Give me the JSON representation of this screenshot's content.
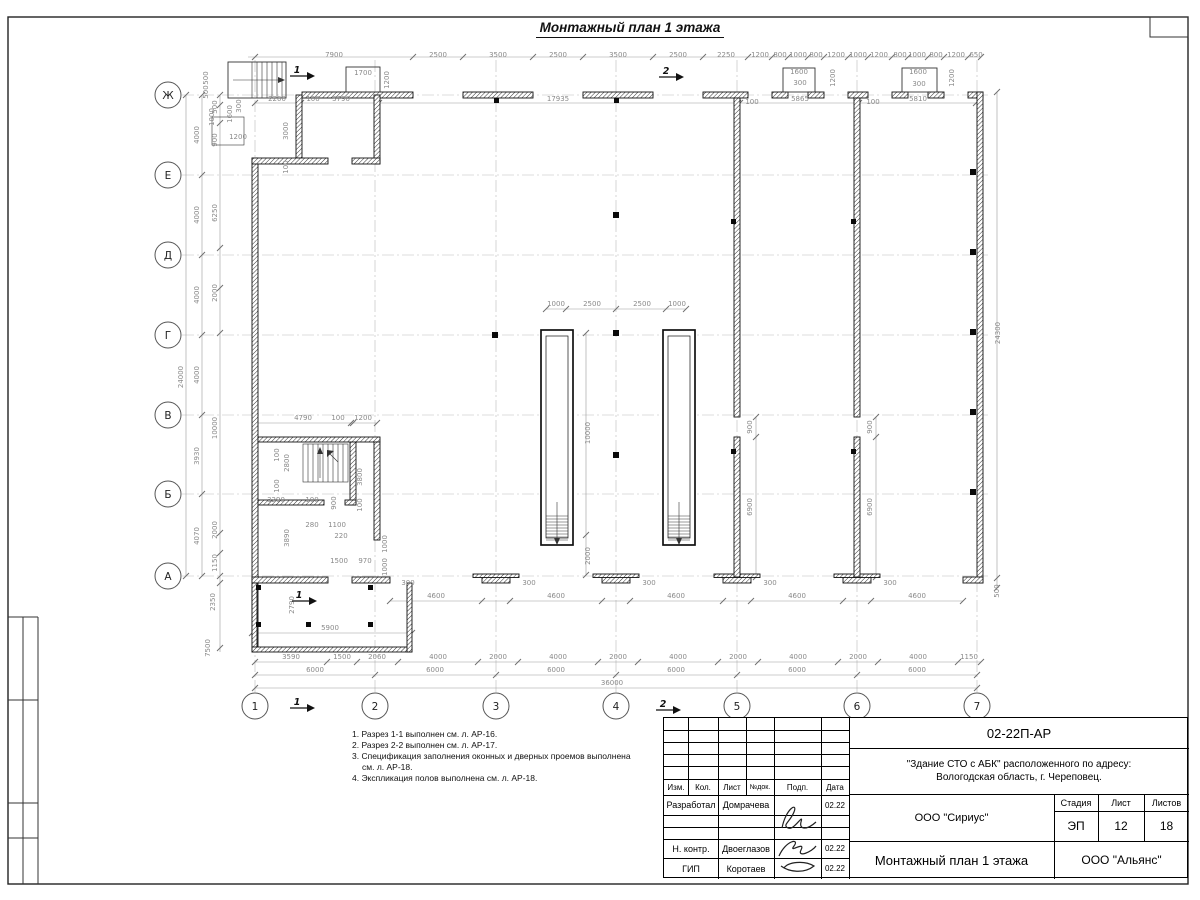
{
  "colors": {
    "ink": "#111111",
    "dim_gray": "#8a8a8a",
    "grid_gray": "#b9b9b9"
  },
  "plan": {
    "title": "Монтажный план 1 этажа",
    "axis_rows": [
      {
        "label": "Ж",
        "y": 95
      },
      {
        "label": "Е",
        "y": 175
      },
      {
        "label": "Д",
        "y": 255
      },
      {
        "label": "Г",
        "y": 335
      },
      {
        "label": "В",
        "y": 415
      },
      {
        "label": "Б",
        "y": 494
      },
      {
        "label": "А",
        "y": 576
      }
    ],
    "axis_cols": [
      {
        "label": "1",
        "x": 255
      },
      {
        "label": "2",
        "x": 375
      },
      {
        "label": "3",
        "x": 496
      },
      {
        "label": "4",
        "x": 616
      },
      {
        "label": "5",
        "x": 737
      },
      {
        "label": "6",
        "x": 857
      },
      {
        "label": "7",
        "x": 977
      }
    ],
    "dim_lines": [
      {
        "y": 57,
        "x1": 248,
        "x2": 981,
        "ticks": [
          255,
          413,
          463,
          533,
          583,
          653,
          703,
          748,
          772,
          788,
          808,
          824,
          848,
          868,
          892,
          908,
          928,
          944,
          968,
          981
        ]
      },
      {
        "y": 103,
        "x1": 255,
        "x2": 976,
        "ticks": [
          255,
          299,
          301,
          377,
          379,
          738,
          740,
          857,
          859,
          976
        ]
      },
      {
        "y": 309,
        "x1": 546,
        "x2": 686,
        "ticks": [
          546,
          566,
          616,
          666,
          686
        ]
      },
      {
        "y": 423,
        "x1": 255,
        "x2": 377,
        "ticks": [
          255,
          351,
          353,
          377
        ]
      },
      {
        "y": 601,
        "x1": 390,
        "x2": 963,
        "ticks": [
          390,
          482,
          510,
          602,
          630,
          723,
          751,
          843,
          871,
          963
        ]
      },
      {
        "y": 633,
        "x1": 252,
        "x2": 412,
        "ticks": [
          252,
          412
        ]
      },
      {
        "y": 662,
        "x1": 255,
        "x2": 981,
        "ticks": [
          255,
          327,
          357,
          398,
          478,
          518,
          598,
          638,
          718,
          758,
          838,
          878,
          958,
          981
        ]
      },
      {
        "y": 675,
        "x1": 255,
        "x2": 977,
        "ticks": [
          255,
          375,
          496,
          616,
          737,
          857,
          977
        ]
      },
      {
        "y": 688,
        "x1": 255,
        "x2": 977,
        "ticks": [
          255,
          977
        ]
      },
      {
        "x": 186,
        "y1": 95,
        "y2": 576,
        "ticks": [
          95,
          576
        ]
      },
      {
        "x": 202,
        "y1": 95,
        "y2": 576,
        "ticks": [
          95,
          175,
          255,
          335,
          415,
          494,
          576
        ]
      },
      {
        "x": 220,
        "y1": 95,
        "y2": 652,
        "ticks": [
          95,
          105,
          123,
          248,
          288,
          333,
          533,
          553,
          576,
          583,
          648
        ]
      },
      {
        "x": 997,
        "y1": 92,
        "y2": 588,
        "ticks": [
          92,
          578,
          588
        ]
      },
      {
        "x": 586,
        "y1": 333,
        "y2": 575,
        "ticks": [
          333,
          535,
          575
        ]
      },
      {
        "x": 756,
        "y1": 417,
        "y2": 577,
        "ticks": [
          417,
          437,
          577
        ]
      },
      {
        "x": 876,
        "y1": 417,
        "y2": 577,
        "ticks": [
          417,
          437,
          577
        ]
      }
    ],
    "dim_labels": [
      [
        334,
        57,
        "7900",
        0
      ],
      [
        438,
        57,
        "2500",
        0
      ],
      [
        498,
        57,
        "3500",
        0
      ],
      [
        558,
        57,
        "2500",
        0
      ],
      [
        618,
        57,
        "3500",
        0
      ],
      [
        678,
        57,
        "2500",
        0
      ],
      [
        726,
        57,
        "2250",
        0
      ],
      [
        760,
        57,
        "1200",
        0
      ],
      [
        780,
        57,
        "800",
        0
      ],
      [
        798,
        57,
        "1000",
        0
      ],
      [
        816,
        57,
        "800",
        0
      ],
      [
        836,
        57,
        "1200",
        0
      ],
      [
        858,
        57,
        "1000",
        0
      ],
      [
        879,
        57,
        "1200",
        0
      ],
      [
        900,
        57,
        "800",
        0
      ],
      [
        917,
        57,
        "1000",
        0
      ],
      [
        936,
        57,
        "800",
        0
      ],
      [
        956,
        57,
        "1200",
        0
      ],
      [
        976,
        57,
        "650",
        0
      ],
      [
        363,
        75,
        "1700",
        0
      ],
      [
        389,
        80,
        "1200",
        1
      ],
      [
        799,
        74,
        "1600",
        0
      ],
      [
        800,
        85,
        "300",
        0
      ],
      [
        835,
        78,
        "1200",
        1
      ],
      [
        918,
        74,
        "1600",
        0
      ],
      [
        919,
        86,
        "300",
        0
      ],
      [
        954,
        78,
        "1200",
        1
      ],
      [
        277,
        101,
        "2200",
        0
      ],
      [
        313,
        101,
        "100",
        0
      ],
      [
        341,
        101,
        "3790",
        0
      ],
      [
        558,
        101,
        "17935",
        0
      ],
      [
        752,
        104,
        "100",
        0
      ],
      [
        800,
        101,
        "5865",
        0
      ],
      [
        873,
        104,
        "100",
        0
      ],
      [
        918,
        101,
        "5810",
        0
      ],
      [
        183,
        377,
        "24000",
        1
      ],
      [
        199,
        135,
        "4000",
        1
      ],
      [
        199,
        215,
        "4000",
        1
      ],
      [
        199,
        295,
        "4000",
        1
      ],
      [
        199,
        375,
        "4000",
        1
      ],
      [
        199,
        456,
        "3930",
        1
      ],
      [
        199,
        536,
        "4070",
        1
      ],
      [
        217,
        107,
        "500",
        1
      ],
      [
        217,
        140,
        "900",
        1
      ],
      [
        217,
        213,
        "6250",
        1
      ],
      [
        217,
        293,
        "2000",
        1
      ],
      [
        217,
        428,
        "10000",
        1
      ],
      [
        217,
        530,
        "2000",
        1
      ],
      [
        217,
        563,
        "1150",
        1
      ],
      [
        215,
        602,
        "2350",
        1
      ],
      [
        210,
        648,
        "7500",
        1
      ],
      [
        208,
        78,
        "500",
        1
      ],
      [
        208,
        92,
        "500",
        1
      ],
      [
        214,
        117,
        "1000",
        1
      ],
      [
        232,
        114,
        "1600",
        1
      ],
      [
        241,
        106,
        "300",
        1
      ],
      [
        238,
        139,
        "1200",
        0
      ],
      [
        288,
        131,
        "3000",
        1
      ],
      [
        288,
        167,
        "100",
        1
      ],
      [
        1000,
        333,
        "24300",
        1
      ],
      [
        999,
        591,
        "500",
        1
      ],
      [
        556,
        306,
        "1000",
        0
      ],
      [
        592,
        306,
        "2500",
        0
      ],
      [
        642,
        306,
        "2500",
        0
      ],
      [
        677,
        306,
        "1000",
        0
      ],
      [
        590,
        433,
        "10000",
        1
      ],
      [
        590,
        556,
        "2000",
        1
      ],
      [
        752,
        427,
        "900",
        1
      ],
      [
        752,
        507,
        "6900",
        1
      ],
      [
        872,
        427,
        "900",
        1
      ],
      [
        872,
        507,
        "6900",
        1
      ],
      [
        303,
        420,
        "4790",
        0
      ],
      [
        338,
        420,
        "100",
        0
      ],
      [
        363,
        420,
        "1200",
        0
      ],
      [
        279,
        455,
        "100",
        1
      ],
      [
        289,
        463,
        "2800",
        1
      ],
      [
        279,
        486,
        "100",
        1
      ],
      [
        276,
        502,
        "3290",
        0
      ],
      [
        312,
        502,
        "100",
        0
      ],
      [
        336,
        503,
        "900",
        1
      ],
      [
        362,
        477,
        "3800",
        1
      ],
      [
        362,
        505,
        "100",
        1
      ],
      [
        312,
        527,
        "280",
        0
      ],
      [
        337,
        527,
        "1100",
        0
      ],
      [
        341,
        538,
        "220",
        0
      ],
      [
        289,
        538,
        "3890",
        1
      ],
      [
        339,
        563,
        "1500",
        0
      ],
      [
        365,
        563,
        "970",
        0
      ],
      [
        387,
        544,
        "1000",
        1
      ],
      [
        387,
        567,
        "1000",
        1
      ],
      [
        408,
        585,
        "300",
        0
      ],
      [
        529,
        585,
        "300",
        0
      ],
      [
        649,
        585,
        "300",
        0
      ],
      [
        770,
        585,
        "300",
        0
      ],
      [
        890,
        585,
        "300",
        0
      ],
      [
        436,
        598,
        "4600",
        0
      ],
      [
        556,
        598,
        "4600",
        0
      ],
      [
        676,
        598,
        "4600",
        0
      ],
      [
        797,
        598,
        "4600",
        0
      ],
      [
        917,
        598,
        "4600",
        0
      ],
      [
        294,
        605,
        "2790",
        1
      ],
      [
        330,
        630,
        "5900",
        0
      ],
      [
        291,
        659,
        "3590",
        0
      ],
      [
        342,
        659,
        "1500",
        0
      ],
      [
        377,
        659,
        "2060",
        0
      ],
      [
        438,
        659,
        "4000",
        0
      ],
      [
        498,
        659,
        "2000",
        0
      ],
      [
        558,
        659,
        "4000",
        0
      ],
      [
        618,
        659,
        "2000",
        0
      ],
      [
        678,
        659,
        "4000",
        0
      ],
      [
        738,
        659,
        "2000",
        0
      ],
      [
        798,
        659,
        "4000",
        0
      ],
      [
        858,
        659,
        "2000",
        0
      ],
      [
        918,
        659,
        "4000",
        0
      ],
      [
        969,
        659,
        "1150",
        0
      ],
      [
        315,
        672,
        "6000",
        0
      ],
      [
        435,
        672,
        "6000",
        0
      ],
      [
        556,
        672,
        "6000",
        0
      ],
      [
        676,
        672,
        "6000",
        0
      ],
      [
        797,
        672,
        "6000",
        0
      ],
      [
        917,
        672,
        "6000",
        0
      ],
      [
        612,
        685,
        "36000",
        0
      ]
    ],
    "sections": [
      {
        "x": 298,
        "y": 73,
        "label": "1"
      },
      {
        "x": 667,
        "y": 74,
        "label": "2"
      },
      {
        "x": 298,
        "y": 705,
        "label": "1"
      },
      {
        "x": 664,
        "y": 707,
        "label": "2"
      },
      {
        "x": 300,
        "y": 598,
        "label": "1"
      }
    ]
  },
  "notes": [
    "1. Разрез 1-1 выполнен см. л. АР-16.",
    "2. Разрез 2-2 выполнен см. л. АР-17.",
    "3. Спецификация заполнения оконных и дверных проемов выполнена см. л. АР-18.",
    "4. Экспликация полов выполнена см. л. АР-18."
  ],
  "title_block": {
    "doc_number": "02-22П-АР",
    "object_line1": "\"Здание СТО с АБК\" расположенного по адресу:",
    "object_line2": "Вологодская область, г. Череповец.",
    "col_izm": "Изм.",
    "col_kol": "Кол.",
    "col_list": "Лист",
    "col_ndok": "№док.",
    "col_podp": "Подп.",
    "col_data": "Дата",
    "r1_role": "Разработал",
    "r1_name": "Домрачева",
    "r1_date": "02.22",
    "r2_role": "Н. контр.",
    "r2_name": "Двоеглазов",
    "r2_date": "02.22",
    "r3_role": "ГИП",
    "r3_name": "Коротаев",
    "r3_date": "02.22",
    "org_design": "ООО \"Сириус\"",
    "org_client": "ООО \"Альянс\"",
    "stage_label": "Стадия",
    "list_label": "Лист",
    "listov_label": "Листов",
    "stage": "ЭП",
    "list_num": "12",
    "listov_num": "18",
    "drawing_title": "Монтажный план 1 этажа"
  }
}
